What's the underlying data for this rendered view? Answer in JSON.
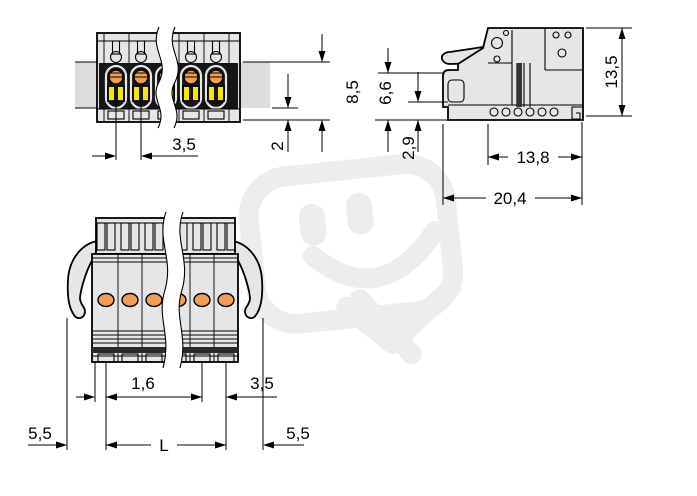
{
  "drawing": {
    "kind": "connector-dimension-drawing",
    "views": {
      "front": {
        "dims": {
          "height": "8,5",
          "rail_offset": "2",
          "pitch": "3,5"
        }
      },
      "side": {
        "dims": {
          "height": "13,5",
          "lever_height": "6,6",
          "foot_height": "2,9",
          "body_depth": "13,8",
          "total_depth": "20,4"
        }
      },
      "plan": {
        "dims": {
          "edge_offset": "1,6",
          "pitch": "3,5",
          "margin_left": "5,5",
          "length": "L",
          "margin_right": "5,5"
        }
      }
    },
    "colors": {
      "body_gray": "#e6e6e6",
      "rail_gray": "#dcdcdc",
      "slot_gray": "#f2f2f2",
      "recess_black": "#161616",
      "hatch_dark": "#2a2a2a",
      "actuator_orange": "#f0a055",
      "clamp_yellow": "#f5e800",
      "watermark_gray": "#ededed",
      "line_black": "#000000",
      "background": "#ffffff"
    }
  }
}
